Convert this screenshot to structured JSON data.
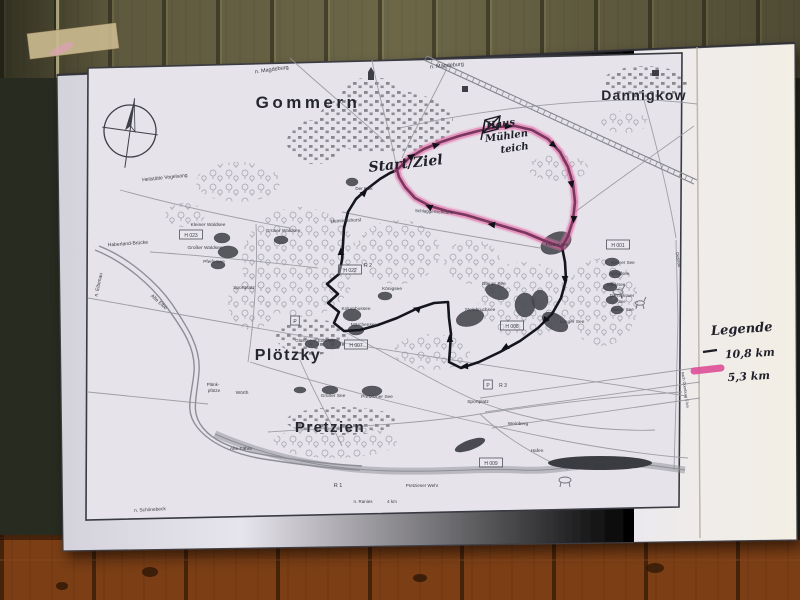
{
  "legend": {
    "title": "Legende",
    "items": [
      {
        "label": "10,8 km",
        "color": "#1a1a22",
        "style": "black-line"
      },
      {
        "label": "5,3 km",
        "color": "#df4f98",
        "style": "pink-highlighter"
      }
    ]
  },
  "map": {
    "labels": [
      {
        "t": "Gommern",
        "x": 308,
        "y": 108,
        "s": 17,
        "c": "town",
        "ls": 3.5
      },
      {
        "t": "Dannigkow",
        "x": 644,
        "y": 100,
        "s": 14,
        "c": "town",
        "ls": 1.2
      },
      {
        "t": "Plötzky",
        "x": 288,
        "y": 360,
        "s": 16,
        "c": "town",
        "ls": 1.5
      },
      {
        "t": "Pretzien",
        "x": 330,
        "y": 432,
        "s": 15,
        "c": "town",
        "ls": 1.5
      },
      {
        "t": "n. Magdeburg",
        "x": 272,
        "y": 71,
        "s": 5.5,
        "r": -8
      },
      {
        "t": "n. Magdeburg",
        "x": 447,
        "y": 67,
        "s": 5.5,
        "r": -5
      },
      {
        "t": "Heilstätte Vogelsang",
        "x": 165,
        "y": 179,
        "s": 5,
        "r": -6
      },
      {
        "t": "Haberland-Brücke",
        "x": 128,
        "y": 245,
        "s": 5,
        "r": -4
      },
      {
        "t": "n. Elbenau",
        "x": 100,
        "y": 285,
        "s": 5,
        "r": -78
      },
      {
        "t": "Alte Elbe",
        "x": 158,
        "y": 303,
        "s": 5,
        "r": 42
      },
      {
        "t": "Kleiner Waldsee",
        "x": 208,
        "y": 226,
        "s": 4.8
      },
      {
        "t": "H 023",
        "x": 191,
        "y": 237,
        "s": 5,
        "b": true
      },
      {
        "t": "Großer Waldsee",
        "x": 205,
        "y": 249,
        "s": 4.8
      },
      {
        "t": "Pfeifersee",
        "x": 214,
        "y": 263,
        "s": 4.8
      },
      {
        "t": "Grüner Waldsee",
        "x": 283,
        "y": 232,
        "s": 4.8
      },
      {
        "t": "Sportplatz",
        "x": 244,
        "y": 289,
        "s": 4.8
      },
      {
        "t": "Heinrichshorst",
        "x": 346,
        "y": 222,
        "s": 4.8,
        "r": -3
      },
      {
        "t": "Der Kulk",
        "x": 364,
        "y": 190,
        "s": 4.5
      },
      {
        "t": "Schlaggenscheune",
        "x": 434,
        "y": 213,
        "s": 4.5,
        "r": 3
      },
      {
        "t": "H 022",
        "x": 350,
        "y": 272,
        "s": 5,
        "b": true
      },
      {
        "t": "R 2",
        "x": 368,
        "y": 267,
        "s": 5
      },
      {
        "t": "Königsee",
        "x": 392,
        "y": 290,
        "s": 4.8
      },
      {
        "t": "Kolumbussee",
        "x": 356,
        "y": 310,
        "s": 4.8
      },
      {
        "t": "Märchensee",
        "x": 364,
        "y": 326,
        "s": 4.8
      },
      {
        "t": "Glassee u. Edersee",
        "x": 315,
        "y": 342,
        "s": 4.5
      },
      {
        "t": "H 007",
        "x": 356,
        "y": 347,
        "s": 5,
        "b": true
      },
      {
        "t": "P",
        "x": 295,
        "y": 323,
        "s": 5,
        "b": true
      },
      {
        "t": "Blauer See",
        "x": 494,
        "y": 285,
        "s": 4.8
      },
      {
        "t": "Steinbruchsee",
        "x": 480,
        "y": 311,
        "s": 4.8
      },
      {
        "t": "H 008",
        "x": 512,
        "y": 328,
        "s": 5,
        "b": true
      },
      {
        "t": "Langer See",
        "x": 572,
        "y": 323,
        "s": 4.8
      },
      {
        "t": "Plattensee",
        "x": 557,
        "y": 246,
        "s": 4.8
      },
      {
        "t": "H 001",
        "x": 618,
        "y": 247,
        "s": 5,
        "b": true
      },
      {
        "t": "Kleiner See",
        "x": 623,
        "y": 264,
        "s": 4.5
      },
      {
        "t": "Schilfsee",
        "x": 620,
        "y": 275,
        "s": 4.5
      },
      {
        "t": "Silbersee",
        "x": 616,
        "y": 286,
        "s": 4.5
      },
      {
        "t": "Dannigkower",
        "x": 622,
        "y": 297,
        "s": 4.2
      },
      {
        "t": "See",
        "x": 622,
        "y": 303,
        "s": 4.2
      },
      {
        "t": "Neuer See",
        "x": 623,
        "y": 311,
        "s": 4.5
      },
      {
        "t": "Dessau",
        "x": 677,
        "y": 260,
        "s": 4.5,
        "r": 80
      },
      {
        "t": "nach Dornburg 5 km",
        "x": 684,
        "y": 390,
        "s": 4,
        "r": 82
      },
      {
        "t": "Plänk-",
        "x": 213,
        "y": 386,
        "s": 4.5
      },
      {
        "t": "pfütze",
        "x": 214,
        "y": 392,
        "s": 4.5
      },
      {
        "t": "Wörth",
        "x": 242,
        "y": 394,
        "s": 4.8
      },
      {
        "t": "Grüner See",
        "x": 333,
        "y": 397,
        "s": 4.8
      },
      {
        "t": "Pretziener See",
        "x": 377,
        "y": 398,
        "s": 4.8
      },
      {
        "t": "Sportplatz",
        "x": 478,
        "y": 403,
        "s": 4.8
      },
      {
        "t": "R 3",
        "x": 503,
        "y": 387,
        "s": 5
      },
      {
        "t": "P",
        "x": 488,
        "y": 387,
        "s": 5,
        "b": true
      },
      {
        "t": "Weinberg",
        "x": 518,
        "y": 425,
        "s": 4.8
      },
      {
        "t": "Hafen",
        "x": 537,
        "y": 452,
        "s": 4.8
      },
      {
        "t": "H 009",
        "x": 491,
        "y": 465,
        "s": 5,
        "b": true
      },
      {
        "t": "Pretziener Wehr",
        "x": 422,
        "y": 487,
        "s": 4.5
      },
      {
        "t": "n. Ranies",
        "x": 363,
        "y": 503,
        "s": 4.5
      },
      {
        "t": "4 km",
        "x": 392,
        "y": 503,
        "s": 4.5
      },
      {
        "t": "R 1",
        "x": 338,
        "y": 487,
        "s": 5.5
      },
      {
        "t": "Alte Fähre",
        "x": 241,
        "y": 450,
        "s": 4.8
      },
      {
        "t": "n. Schönebeck",
        "x": 150,
        "y": 511,
        "s": 4.8,
        "r": -3
      },
      {
        "t": "Start/Ziel",
        "x": 406,
        "y": 168,
        "s": 14,
        "r": -6,
        "c": "hand"
      },
      {
        "t": "Haus",
        "x": 501,
        "y": 127,
        "s": 10,
        "r": -8,
        "c": "hand"
      },
      {
        "t": "Mühlen",
        "x": 507,
        "y": 139,
        "s": 10,
        "r": -8,
        "c": "hand"
      },
      {
        "t": "teich",
        "x": 515,
        "y": 151,
        "s": 10,
        "r": -8,
        "c": "hand"
      }
    ],
    "routes": {
      "top_arc": [
        [
          397,
          170
        ],
        [
          409,
          158
        ],
        [
          424,
          149
        ],
        [
          441,
          142
        ],
        [
          459,
          136
        ],
        [
          478,
          131
        ],
        [
          497,
          127
        ],
        [
          515,
          126
        ],
        [
          532,
          130
        ],
        [
          548,
          139
        ],
        [
          560,
          152
        ],
        [
          568,
          167
        ],
        [
          573,
          184
        ],
        [
          575,
          202
        ],
        [
          573,
          220
        ],
        [
          568,
          236
        ],
        [
          562,
          247
        ]
      ],
      "middle_back": [
        [
          545,
          241
        ],
        [
          526,
          233
        ],
        [
          506,
          227
        ],
        [
          486,
          221
        ],
        [
          466,
          215
        ],
        [
          447,
          211
        ],
        [
          430,
          206
        ],
        [
          415,
          198
        ],
        [
          405,
          187
        ],
        [
          399,
          177
        ]
      ],
      "south_return": [
        [
          565,
          262
        ],
        [
          566,
          280
        ],
        [
          561,
          298
        ],
        [
          552,
          314
        ],
        [
          538,
          328
        ],
        [
          520,
          341
        ],
        [
          500,
          352
        ],
        [
          479,
          362
        ],
        [
          461,
          368
        ],
        [
          449,
          362
        ],
        [
          450,
          349
        ],
        [
          451,
          334
        ],
        [
          449,
          318
        ],
        [
          448,
          302
        ],
        [
          434,
          303
        ],
        [
          416,
          309
        ],
        [
          397,
          318
        ],
        [
          378,
          325
        ],
        [
          360,
          330
        ],
        [
          344,
          331
        ],
        [
          334,
          323
        ],
        [
          339,
          312
        ],
        [
          328,
          303
        ],
        [
          338,
          294
        ],
        [
          327,
          284
        ],
        [
          339,
          274
        ],
        [
          342,
          260
        ],
        [
          343,
          244
        ],
        [
          344,
          228
        ],
        [
          348,
          212
        ],
        [
          356,
          199
        ],
        [
          367,
          189
        ],
        [
          380,
          179
        ],
        [
          390,
          173
        ]
      ],
      "arrows": [
        [
          433,
          146,
          -16
        ],
        [
          505,
          126,
          4
        ],
        [
          551,
          143,
          38
        ],
        [
          571,
          181,
          80
        ],
        [
          574,
          216,
          95
        ],
        [
          565,
          276,
          92
        ],
        [
          547,
          318,
          130
        ],
        [
          508,
          346,
          152
        ],
        [
          468,
          366,
          175
        ],
        [
          450,
          342,
          265
        ],
        [
          420,
          310,
          197
        ],
        [
          341,
          255,
          268
        ],
        [
          362,
          195,
          315
        ],
        [
          495,
          225,
          188
        ],
        [
          432,
          208,
          205
        ],
        [
          409,
          158,
          -35
        ]
      ]
    }
  }
}
